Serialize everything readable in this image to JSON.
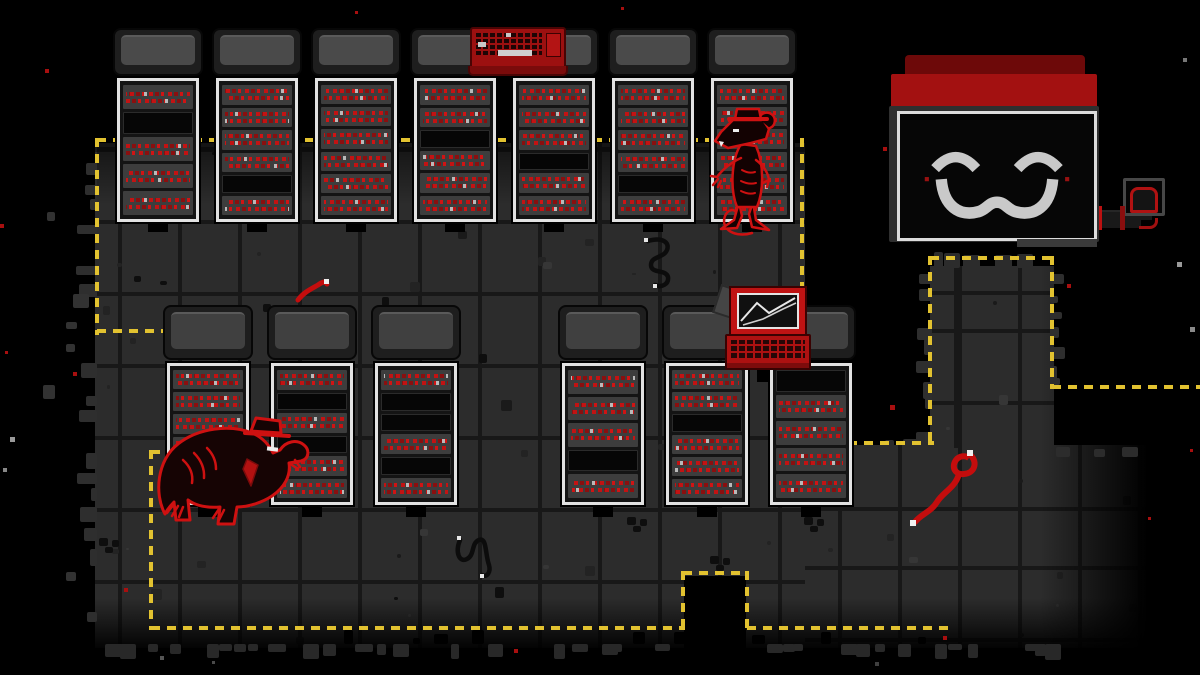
{
  "scene": {
    "name": "Server room with smiling mainframe and rats",
    "style": "pixel-art",
    "background": "#000000"
  },
  "palette": {
    "floor_tile": "#2c2c2c",
    "floor_grout": "#181818",
    "boundary_yellow": "#e2c230",
    "rack_border": "#e2e2e2",
    "rack_unit": "#3d3d3d",
    "status_text_red": "#c21313",
    "monitor_cap_red": "#a31111",
    "face_gray": "#c9c9c9",
    "device_red": "#b31414",
    "creature_red": "#ce1111"
  },
  "entities": [
    {
      "id": "mainframe-monitor",
      "label": "Smiling mainframe monitor"
    },
    {
      "id": "keyboard-device",
      "label": "Red keyboard on server rack"
    },
    {
      "id": "laptop-device",
      "label": "Red laptop with cracked screen"
    },
    {
      "id": "rat-standing",
      "label": "Rat in hat standing at server rack"
    },
    {
      "id": "rat-hunched",
      "label": "Large hunched rat in hat"
    },
    {
      "id": "red-worm-small",
      "label": "Small red worm"
    },
    {
      "id": "red-worm-large",
      "label": "Large red worm"
    },
    {
      "id": "cable-worm-upper",
      "label": "Black cable worm"
    },
    {
      "id": "cable-worm-lower",
      "label": "Black cable worm"
    },
    {
      "id": "pipe-fitting",
      "label": "Wall pipe with red valve"
    },
    {
      "id": "boundary",
      "label": "Yellow dashed patrol boundary"
    }
  ],
  "racks": {
    "top_row_units": [
      "TBTTT",
      "TTTTBT",
      "TTTTTT",
      "TTBTTT",
      "TTTBTT",
      "TTTTBT",
      "TTTTTT"
    ],
    "bottom_row_units": [
      "TTTTBT",
      "TBTBTT",
      "TBBTBT",
      "TTTBT",
      "TTBTTT",
      "BTTTT"
    ],
    "unit_legend": {
      "T": "server unit with red status text",
      "B": "empty black bay"
    }
  },
  "monitor_face": {
    "eyes": "closed-happy-arcs",
    "mouth": "wavy-smile",
    "cheek_dots": 2
  }
}
